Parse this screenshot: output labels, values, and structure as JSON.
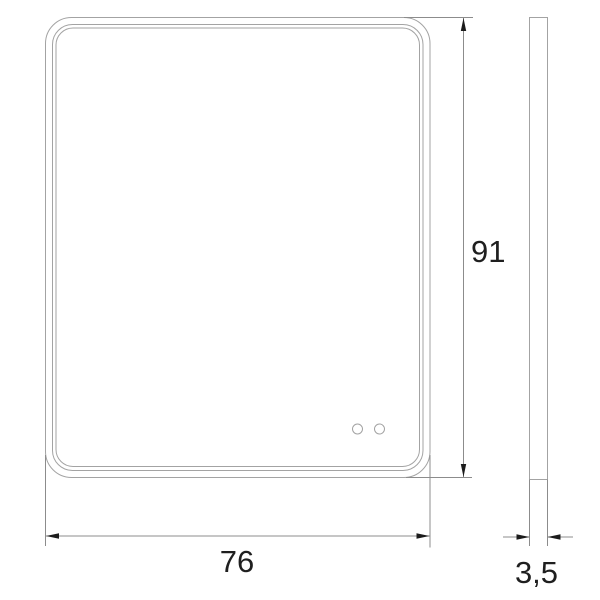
{
  "drawing": {
    "dimensions": {
      "width_label": "76",
      "height_label": "91",
      "depth_label": "3,5"
    },
    "colors": {
      "background": "#ffffff",
      "object_line": "#a3a3a3",
      "dimension_line": "#8c8c8c",
      "arrow": "#1c1c1c",
      "label_text": "#1f1f1f"
    }
  }
}
